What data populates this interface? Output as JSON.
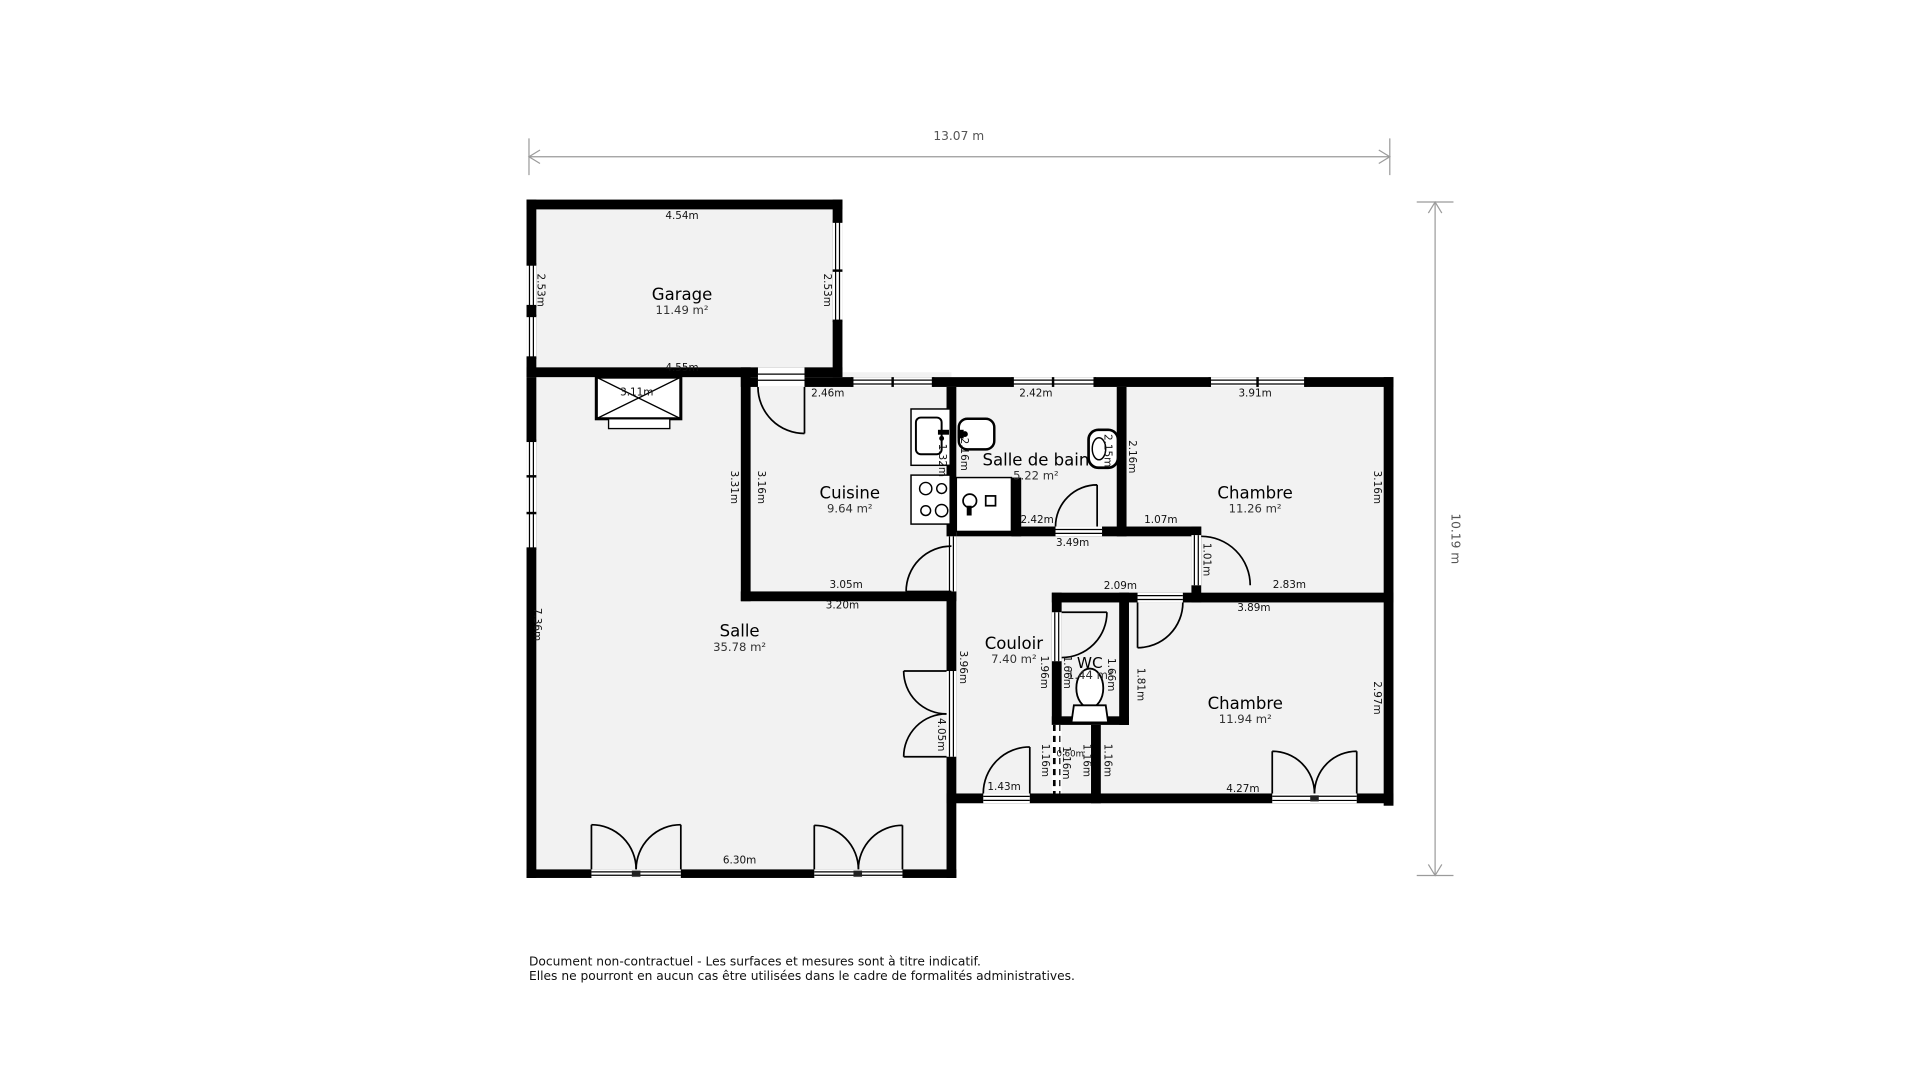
{
  "overall_dimensions": {
    "width_label": "13.07 m",
    "height_label": "10.19 m"
  },
  "rooms": [
    {
      "key": "garage",
      "name": "Garage",
      "area": "11.49 m²",
      "x": 557,
      "y": 241
    },
    {
      "key": "cuisine",
      "name": "Cuisine",
      "area": "9.64 m²",
      "x": 694,
      "y": 403
    },
    {
      "key": "salle-de-bain",
      "name": "Salle de bain",
      "area": "5.22 m²",
      "x": 846,
      "y": 376
    },
    {
      "key": "chambre-1",
      "name": "Chambre",
      "area": "11.26 m²",
      "x": 1025,
      "y": 403
    },
    {
      "key": "salle",
      "name": "Salle",
      "area": "35.78 m²",
      "x": 604,
      "y": 516
    },
    {
      "key": "couloir",
      "name": "Couloir",
      "area": "7.40 m²",
      "x": 828,
      "y": 526
    },
    {
      "key": "wc",
      "name": "WC",
      "area": "1.44 m²",
      "x": 890,
      "y": 541,
      "small": true
    },
    {
      "key": "chambre-2",
      "name": "Chambre",
      "area": "11.94 m²",
      "x": 1017,
      "y": 575
    }
  ],
  "dims": [
    {
      "t": "4.54m",
      "x": 557,
      "y": 177,
      "o": "h"
    },
    {
      "t": "2.53m",
      "x": 441,
      "y": 237,
      "o": "v"
    },
    {
      "t": "2.53m",
      "x": 675,
      "y": 237,
      "o": "v"
    },
    {
      "t": "4.55m",
      "x": 557,
      "y": 301,
      "o": "h"
    },
    {
      "t": "3.11m",
      "x": 520,
      "y": 321,
      "o": "h"
    },
    {
      "t": "2.46m",
      "x": 676,
      "y": 322,
      "o": "h"
    },
    {
      "t": "2.42m",
      "x": 846,
      "y": 322,
      "o": "h"
    },
    {
      "t": "3.91m",
      "x": 1025,
      "y": 322,
      "o": "h"
    },
    {
      "t": "3.31m",
      "x": 599,
      "y": 398,
      "o": "v"
    },
    {
      "t": "3.16m",
      "x": 621,
      "y": 398,
      "o": "v"
    },
    {
      "t": "1.32m",
      "x": 769,
      "y": 376,
      "o": "v"
    },
    {
      "t": "2.16m",
      "x": 787,
      "y": 371,
      "o": "v"
    },
    {
      "t": "2.15m",
      "x": 904,
      "y": 368,
      "o": "v"
    },
    {
      "t": "2.16m",
      "x": 924,
      "y": 373,
      "o": "v"
    },
    {
      "t": "3.16m",
      "x": 1124,
      "y": 398,
      "o": "v"
    },
    {
      "t": "3.05m",
      "x": 691,
      "y": 478,
      "o": "h"
    },
    {
      "t": "2.42m",
      "x": 847,
      "y": 425,
      "o": "h"
    },
    {
      "t": "1.07m",
      "x": 948,
      "y": 425,
      "o": "h"
    },
    {
      "t": "3.49m",
      "x": 876,
      "y": 444,
      "o": "h"
    },
    {
      "t": "3.20m",
      "x": 688,
      "y": 495,
      "o": "h"
    },
    {
      "t": "2.09m",
      "x": 915,
      "y": 479,
      "o": "h"
    },
    {
      "t": "2.83m",
      "x": 1053,
      "y": 478,
      "o": "h"
    },
    {
      "t": "3.89m",
      "x": 1024,
      "y": 497,
      "o": "h"
    },
    {
      "t": "1.01m",
      "x": 985,
      "y": 457,
      "o": "v"
    },
    {
      "t": "7.36m",
      "x": 438,
      "y": 510,
      "o": "v"
    },
    {
      "t": "3.96m",
      "x": 786,
      "y": 545,
      "o": "v"
    },
    {
      "t": "4.05m",
      "x": 768,
      "y": 600,
      "o": "v"
    },
    {
      "t": "1.96m",
      "x": 852,
      "y": 549,
      "o": "v"
    },
    {
      "t": "1.66m",
      "x": 871,
      "y": 549,
      "o": "v"
    },
    {
      "t": "1.66m",
      "x": 907,
      "y": 551,
      "o": "v"
    },
    {
      "t": "1.81m",
      "x": 931,
      "y": 559,
      "o": "v"
    },
    {
      "t": "2.97m",
      "x": 1124,
      "y": 570,
      "o": "v"
    },
    {
      "t": "1.16m",
      "x": 853,
      "y": 621,
      "o": "v"
    },
    {
      "t": "0.60m",
      "x": 874,
      "y": 616,
      "o": "h",
      "s": true
    },
    {
      "t": "1.16m",
      "x": 870,
      "y": 623,
      "o": "v"
    },
    {
      "t": "1.16m",
      "x": 887,
      "y": 621,
      "o": "v"
    },
    {
      "t": "1.16m",
      "x": 904,
      "y": 621,
      "o": "v"
    },
    {
      "t": "1.43m",
      "x": 820,
      "y": 643,
      "o": "h"
    },
    {
      "t": "6.30m",
      "x": 604,
      "y": 703,
      "o": "h"
    },
    {
      "t": "4.27m",
      "x": 1015,
      "y": 645,
      "o": "h"
    }
  ],
  "disclaimer": [
    "Document non-contractuel - Les surfaces et mesures sont à titre indicatif.",
    "Elles ne pourront en aucun cas être utilisées dans le cadre de formalités administratives."
  ],
  "colors": {
    "wall": "#000000",
    "floor": "#f2f2f2",
    "dim_text": "#111111",
    "overall_dim_line": "#9b9b9b",
    "overall_dim_text": "#555555"
  }
}
